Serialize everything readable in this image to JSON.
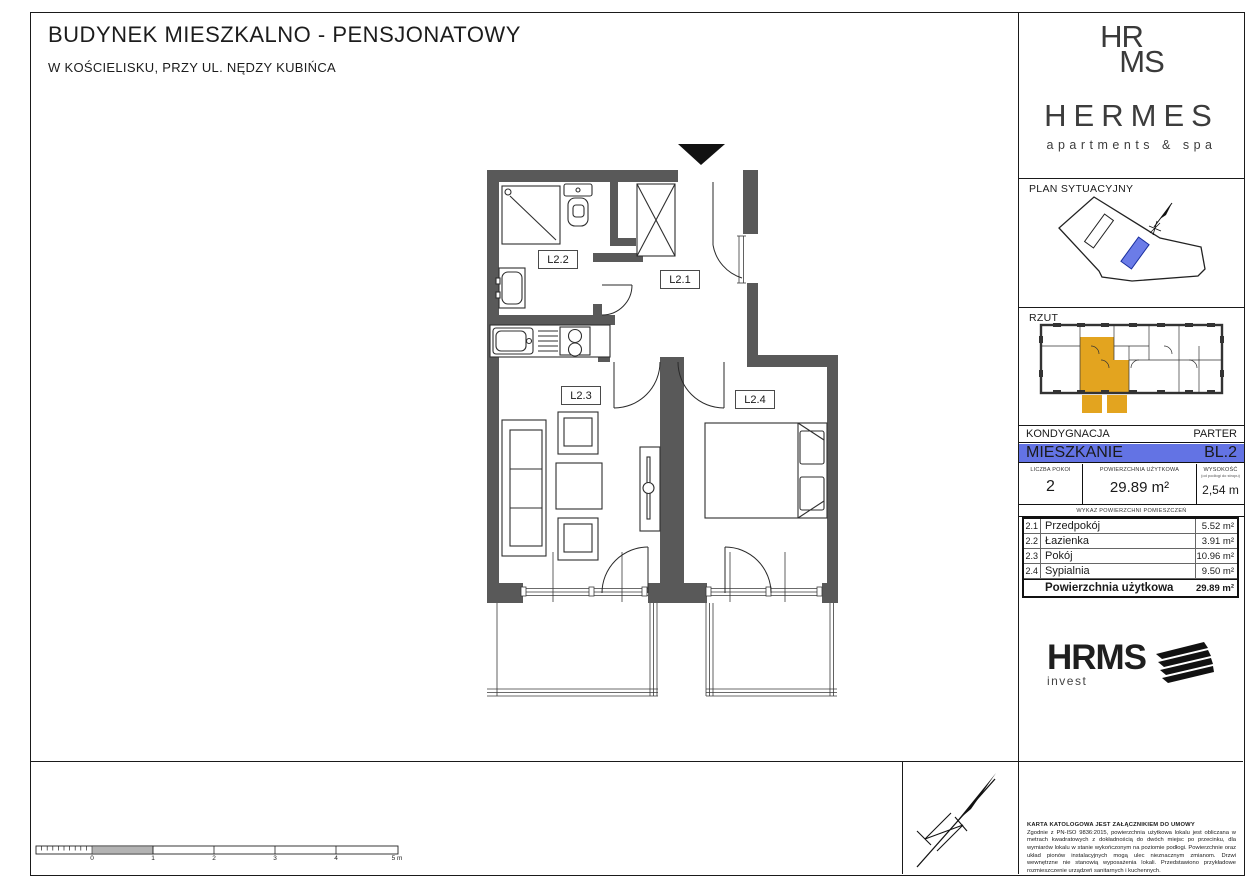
{
  "page": {
    "title": "BUDYNEK MIESZKALNO - PENSJONATOWY",
    "subtitle": "W KOŚCIELISKU, PRZY UL. NĘDZY KUBIŃCA"
  },
  "plan": {
    "room_labels": {
      "l21": "L2.1",
      "l22": "L2.2",
      "l23": "L2.3",
      "l24": "L2.4"
    }
  },
  "scale_bar": {
    "labels": [
      "0",
      "1",
      "2",
      "3",
      "4",
      "5 m"
    ]
  },
  "sidebar": {
    "brand": {
      "monogram_line1": "HR",
      "monogram_line2": "MS",
      "name": "HERMES",
      "tagline": "apartments & spa"
    },
    "sections": {
      "site_plan": "PLAN SYTUACYJNY",
      "floor_overview": "RZUT"
    },
    "info": {
      "kondygnacja_label": "KONDYGNACJA",
      "kondygnacja_value": "PARTER",
      "mieszkanie_label": "MIESZKANIE",
      "mieszkanie_value": "BL.2",
      "stats": [
        {
          "label": "LICZBA POKOI",
          "value": "2"
        },
        {
          "label": "POWIERZCHNIA UŻYTKOWA",
          "value": "29.89 m²"
        },
        {
          "label": "WYSOKOŚĆ",
          "sublabel": "(od podłogi do stropu)",
          "value": "2,54 m"
        }
      ],
      "rooms_header": "WYKAZ POWIERZCHNI POMIESZCZEŃ",
      "rooms": [
        {
          "no": "2.1",
          "name": "Przedpokój",
          "area": "5.52 m²"
        },
        {
          "no": "2.2",
          "name": "Łazienka",
          "area": "3.91 m²"
        },
        {
          "no": "2.3",
          "name": "Pokój",
          "area": "10.96 m²"
        },
        {
          "no": "2.4",
          "name": "Sypialnia",
          "area": "9.50 m²"
        }
      ],
      "total_label": "Powierzchnia użytkowa",
      "total_value": "29.89 m²"
    },
    "invest": {
      "name": "HRMS",
      "sub": "invest"
    },
    "legal": {
      "heading": "KARTA KATOLOGOWA JEST ZAŁĄCZNIKIEM DO UMOWY",
      "body": "Zgodnie z PN-ISO 9836:2015, powierzchnia użytkowa lokalu jest obliczana w metrach kwadratowych z dokładnością do dwóch miejsc po przecinku, dla wymiarów lokalu w stanie wykończonym na poziomie podłogi. Powierzchnie oraz układ pionów instalacyjnych mogą ulec nieznacznym zmianom. Drzwi wewnętrzne nie stanowią wyposażenia lokali. Przedstawiono przykładowe rozmieszczenie urządzeń sanitarnych i kuchennych."
    }
  },
  "colors": {
    "highlight_blue": "#6373e4",
    "highlight_orange": "#e3a41f",
    "wall": "#595959",
    "site_building_blue": "#6b7ce8"
  }
}
